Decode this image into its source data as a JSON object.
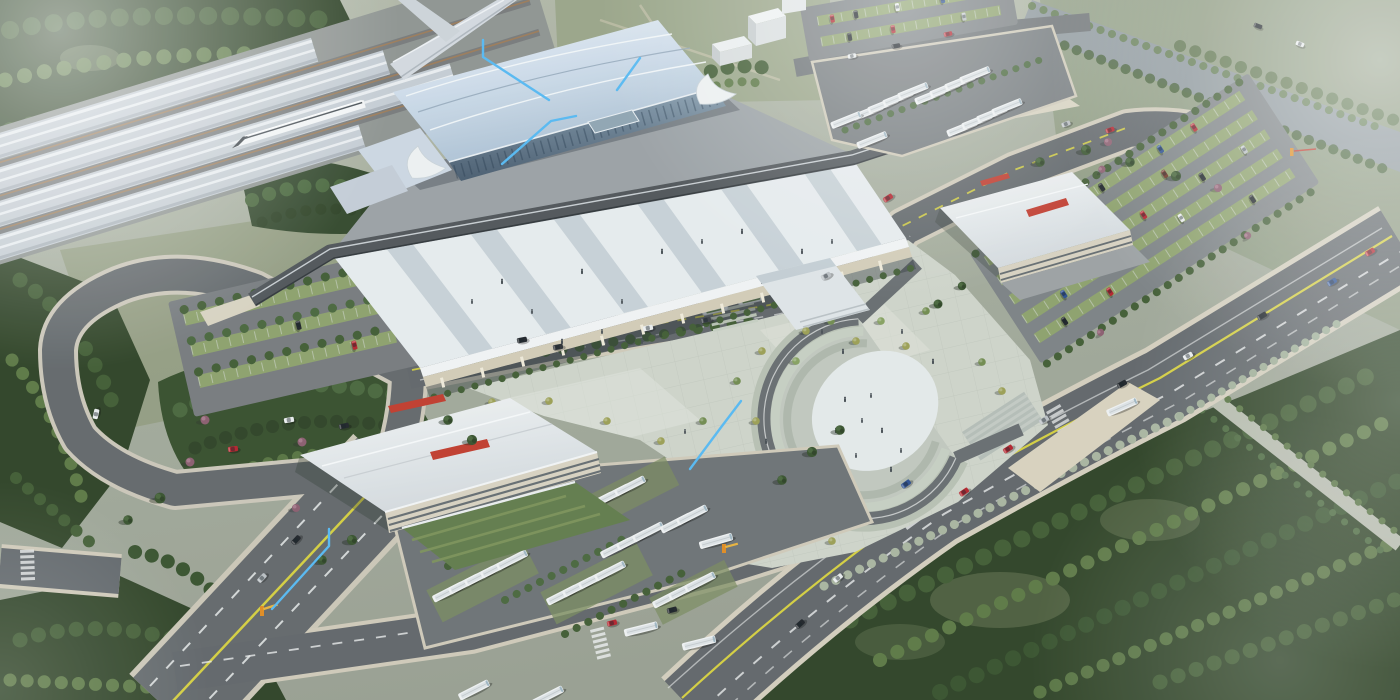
{
  "meta": {
    "type": "aerial-architectural-rendering",
    "subject": "high-speed railway station and transit hub master plan, bird's-eye view",
    "style": "photoreal 3D render with atmospheric haze, no visible UI or legible text"
  },
  "palette": {
    "ground": "#a2a99b",
    "grass_light": "#8d9a78",
    "forest_dark": "#2c4023",
    "forest_mid": "#3f5a31",
    "forest_light": "#5a7642",
    "tree_pink": "#8a5b6d",
    "plaza_paving": "#ced3c9",
    "plaza_light": "#dfe3da",
    "road_asphalt": "#5f6468",
    "road_curb": "#cfc9b8",
    "lane_yellow": "#d4ce3e",
    "lane_white": "#e8eaea",
    "station_roof": "#ccdae8",
    "glass": "#64798d",
    "deck_light": "#e6ebee",
    "deck_band": "#c3cdd3",
    "viaduct": "#4e5357",
    "platform_canopy": "#c5ccd3",
    "train_white": "#f3f5f6",
    "building_white": "#e9ecee",
    "facade_cream": "#d7d1c0",
    "signage_red": "#c0392b",
    "bus_white": "#eff1f2",
    "annotation_blue": "#55b8f2",
    "gate_orange": "#e08a1e",
    "oval_white": "#e4e9e9",
    "steps_sage": "#b7bfb2",
    "water": "#8d969b",
    "haze": "#ffffff"
  },
  "scene": {
    "elements": [
      {
        "name": "rail-corridor",
        "desc": "multi-track corridor with four platform canopies and a white high-speed train"
      },
      {
        "name": "station-hall",
        "desc": "long curved-roof station hall with glass curtain wall and white swoosh wings"
      },
      {
        "name": "forecourt-deck",
        "desc": "elevated banded forecourt deck with pedestrians on columns"
      },
      {
        "name": "elevated-viaduct",
        "desc": "dark drop-off viaduct along the deck rear edge with ramps"
      },
      {
        "name": "central-plaza",
        "desc": "paved pedestrian plaza planted with young trees"
      },
      {
        "name": "horseshoe-amphitheater",
        "desc": "U-shaped stepped sunken plaza with pale oval floor and people"
      },
      {
        "name": "west-terminal-building",
        "desc": "white garage-style terminal with red rooftop signage and green bus bays"
      },
      {
        "name": "east-terminal-building",
        "desc": "white terminal building with red rooftop signage"
      },
      {
        "name": "south-bus-depot",
        "desc": "bus staging yard with rows of white coaches and hedge strips"
      },
      {
        "name": "northeast-bus-depot",
        "desc": "second bus yard beside descending ramp"
      },
      {
        "name": "parking-west",
        "desc": "hedge-lined surface car park inside loop road"
      },
      {
        "name": "parking-east",
        "desc": "large surface car park with many parked cars"
      },
      {
        "name": "parking-north",
        "desc": "small car park behind the station"
      },
      {
        "name": "road-network",
        "desc": "arterial, loop and service roads with yellow/white lane markings, crosswalks and traffic"
      },
      {
        "name": "river-channel",
        "desc": "hazy waterway crossing the top-right corner with tree-lined banks"
      },
      {
        "name": "forest-belts",
        "desc": "dense tree masses framing the site with grassy clearings and a tree-lined alley"
      },
      {
        "name": "annotation-leaders",
        "desc": "light-blue leader lines drawn over the rendering"
      },
      {
        "name": "entry-gates",
        "desc": "small orange barrier gates at depot entrances"
      }
    ],
    "signage": {
      "text_legible": false,
      "strips": 4,
      "color_ref": "signage_red"
    },
    "annotations": {
      "count": 5,
      "color_ref": "annotation_blue"
    }
  }
}
